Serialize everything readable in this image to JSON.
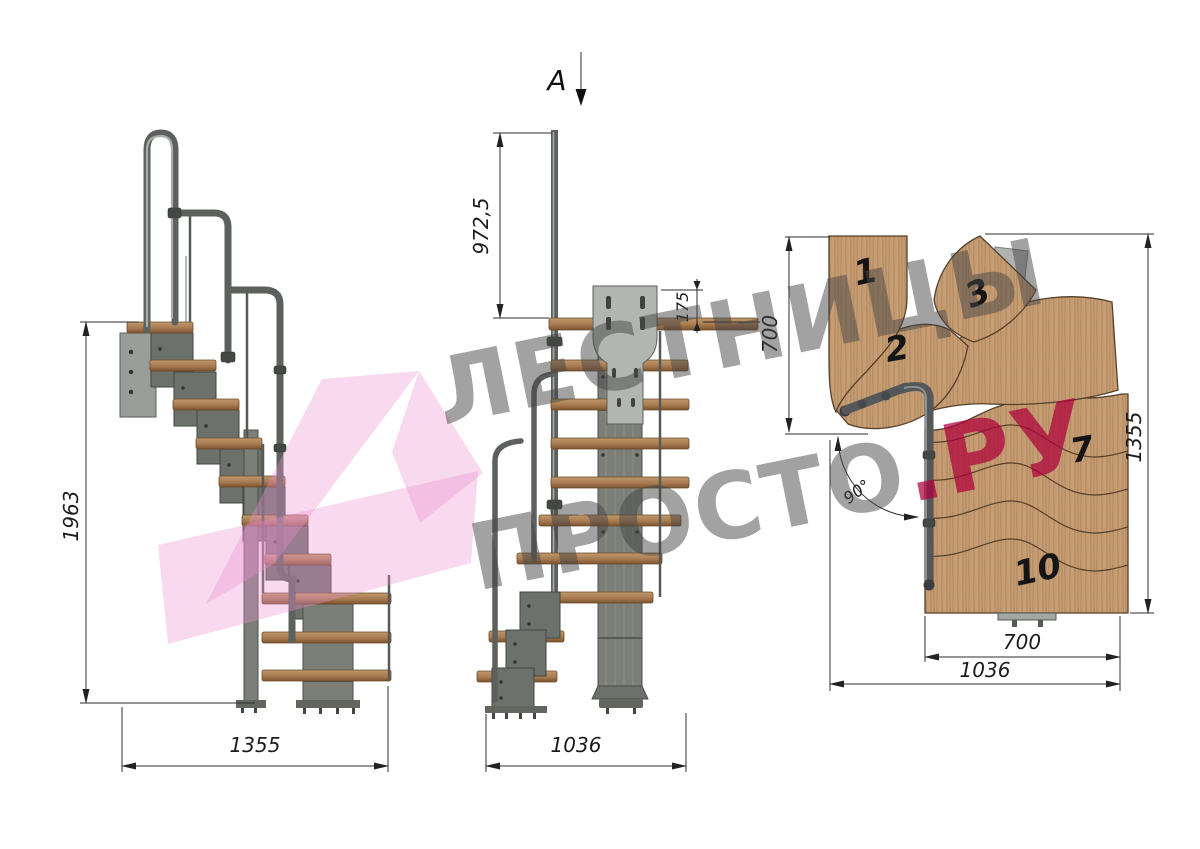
{
  "watermark": {
    "line1": "ЛЕСТНИЦЫ",
    "line2_main": "ПРОСТО",
    "line2_accent": ".РУ"
  },
  "side_view": {
    "height": "1963",
    "width": "1355"
  },
  "front_view": {
    "section_label": "A",
    "handrail_height": "972,5",
    "plate_offset": "175",
    "width": "1036"
  },
  "plan_view": {
    "turn_depth": "700",
    "total_length": "1355",
    "flight_width": "700",
    "total_width": "1036",
    "turn_angle": "90°",
    "tread_numbers": [
      "1",
      "2",
      "3",
      "7",
      "10"
    ]
  },
  "colors": {
    "wood": "#c59d74",
    "wood_edge": "#54402b",
    "tread_side": "#a97d54",
    "metal": "#73766f",
    "metal_light": "#b2b6b3",
    "dimension_line": "#2e2e2e",
    "watermark_pink": "#ec93d0",
    "watermark_gray": "#7d7d7d",
    "watermark_accent": "#c3406d"
  }
}
